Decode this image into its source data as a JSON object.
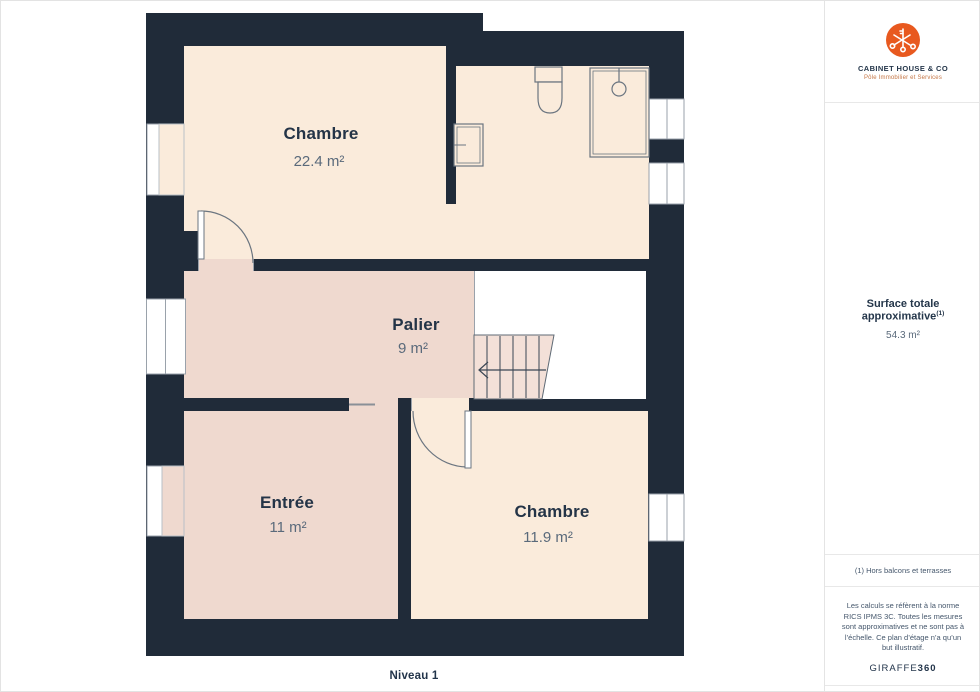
{
  "plan": {
    "level_label": "Niveau 1",
    "rooms": [
      {
        "name": "Chambre",
        "area": "22.4 m²"
      },
      {
        "name": "Palier",
        "area": "9 m²"
      },
      {
        "name": "Entrée",
        "area": "11 m²"
      },
      {
        "name": "Chambre",
        "area": "11.9 m²"
      }
    ],
    "colors": {
      "wall": "#202B39",
      "room_cream": "#FAEBDB",
      "room_pink": "#EFD9CF",
      "stairs": "#F3E0D8"
    }
  },
  "sidebar": {
    "logo": {
      "title": "CABINET HOUSE & CO",
      "subtitle": "Pôle Immobilier et Services",
      "accent_color": "#E8591F"
    },
    "surface": {
      "label": "Surface totale approximative",
      "footnote_marker": "(1)",
      "value": "54.3 m²"
    },
    "footnote": "(1) Hors balcons et terrasses",
    "legal": "Les calculs se réfèrent à la norme RICS IPMS 3C. Toutes les mesures sont approximatives et ne sont pas à l’échelle. Ce plan d’étage n’a qu’un but illustratif.",
    "brand": {
      "name": "GIRAFFE",
      "suffix": "360"
    }
  }
}
